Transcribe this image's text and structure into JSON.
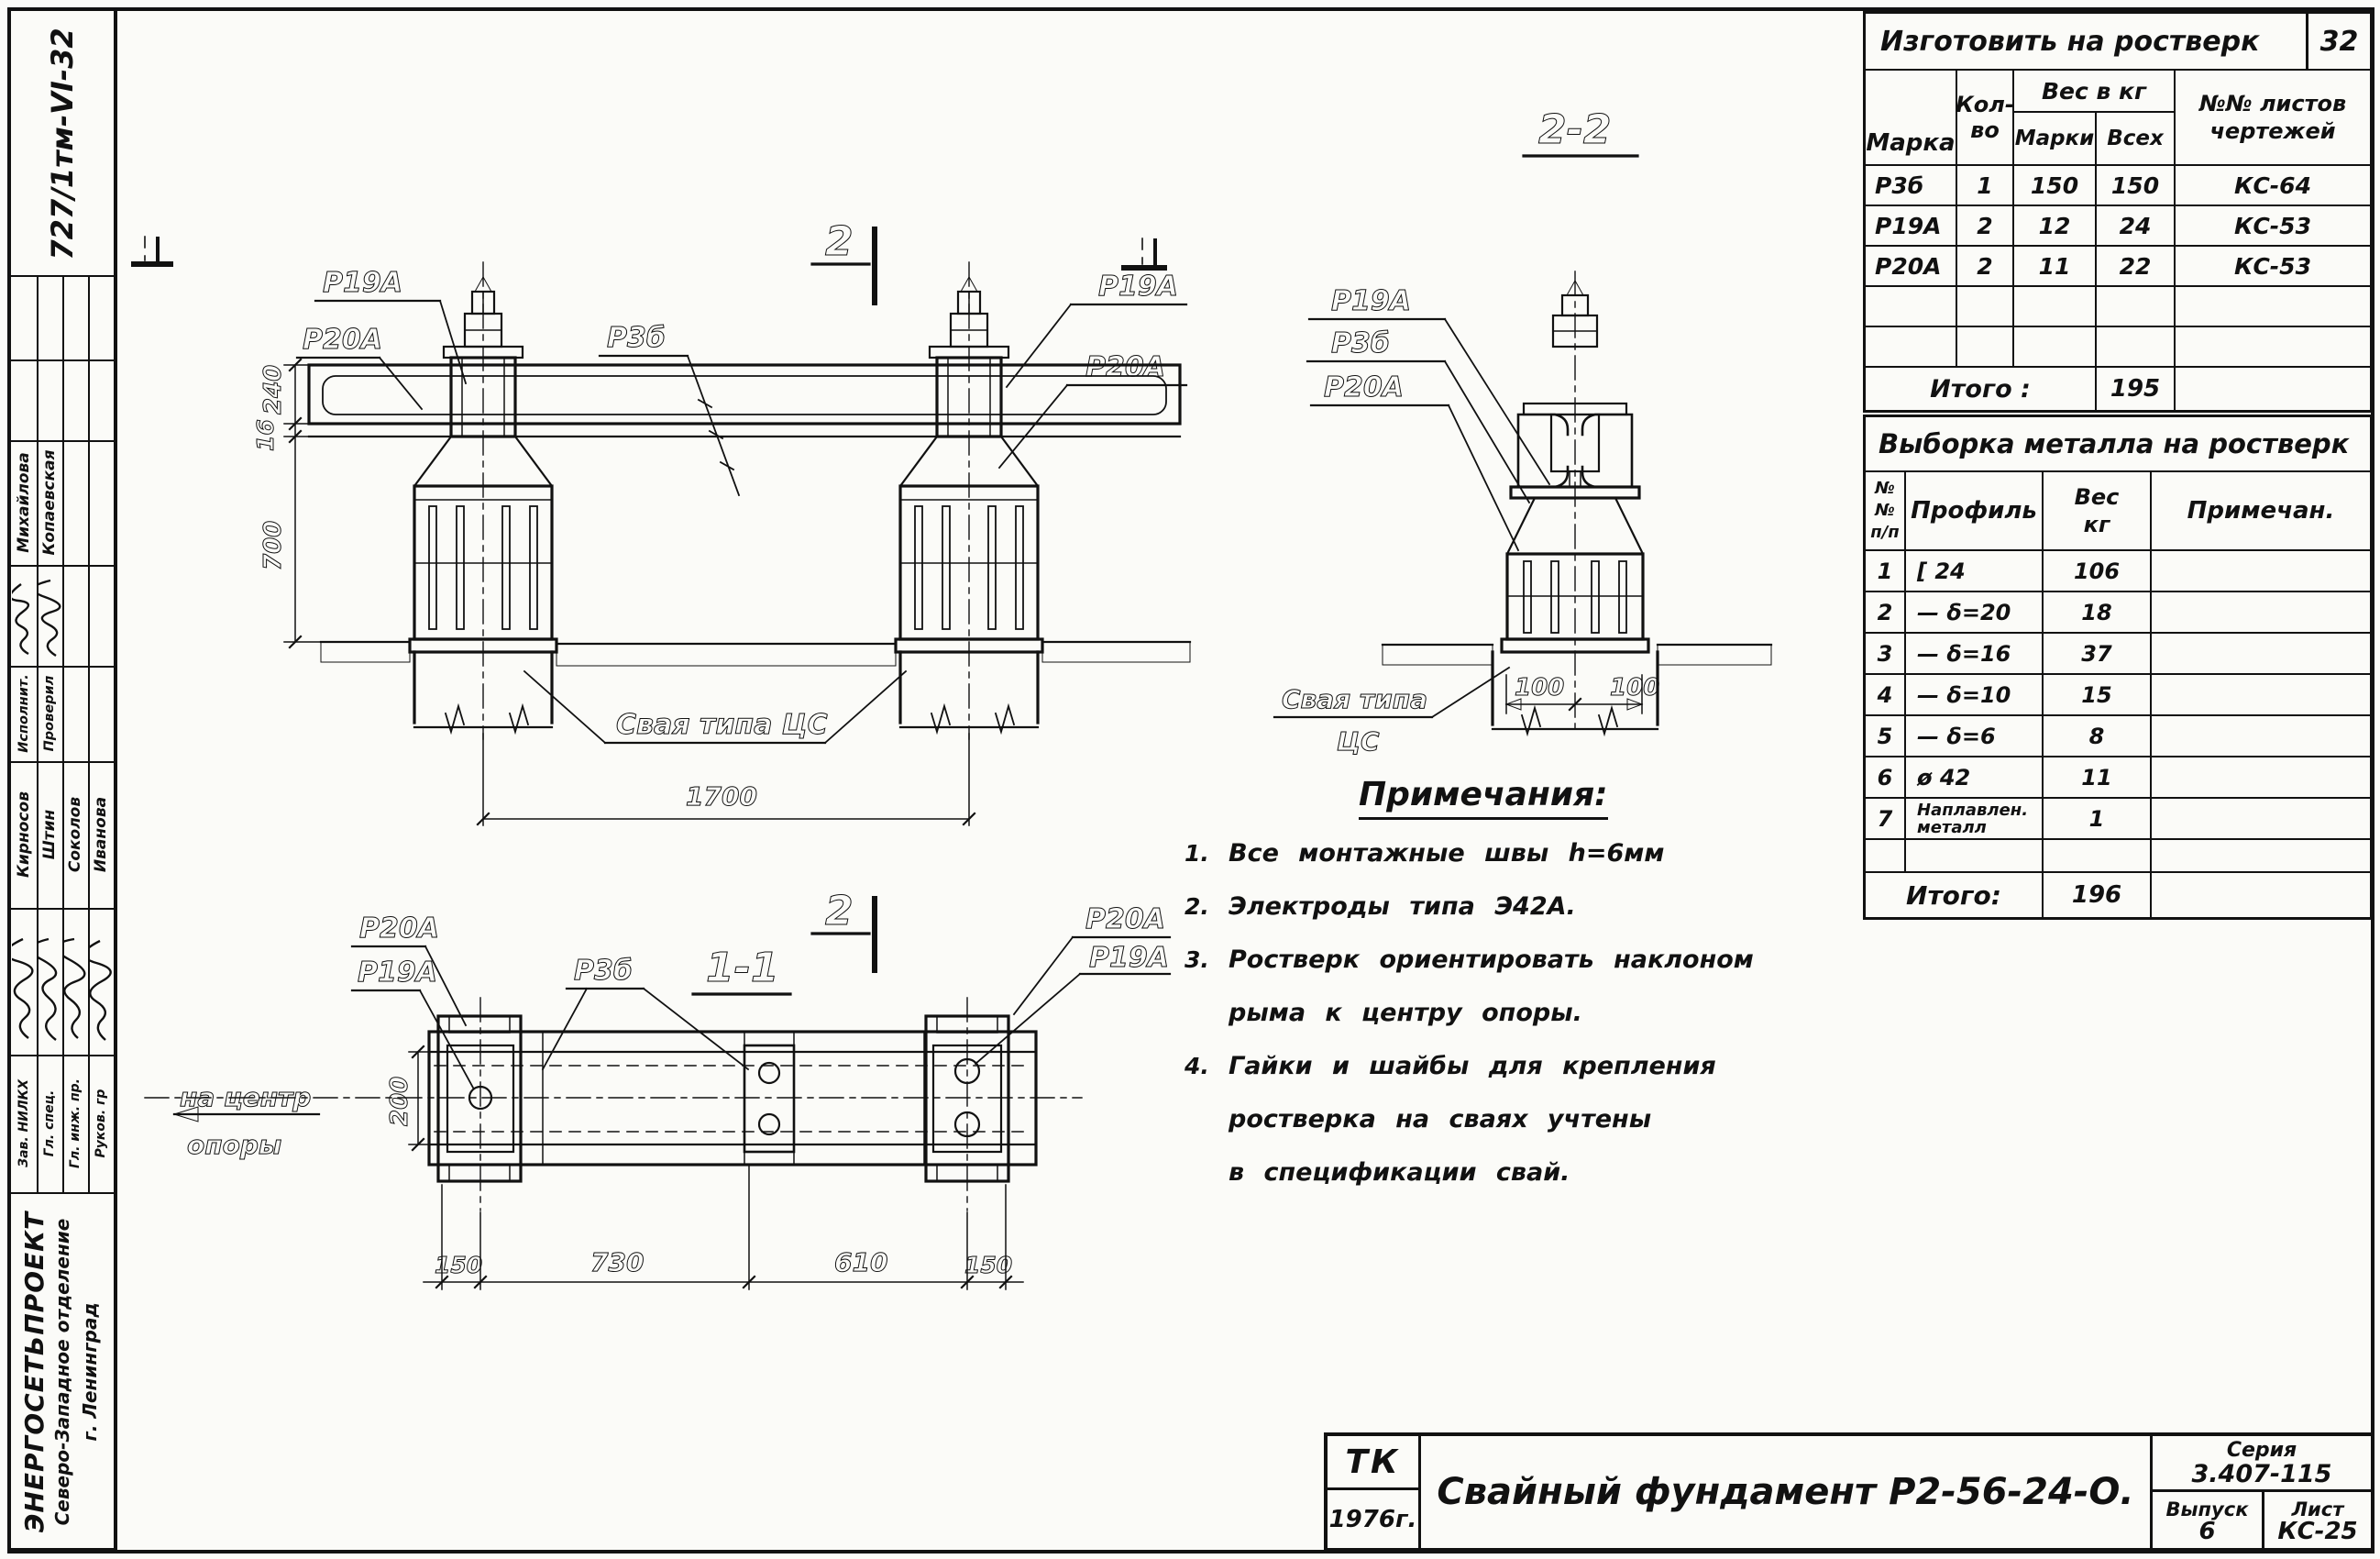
{
  "sheet": {
    "archive_stamp": "727/1тм-VI-32",
    "org": {
      "name": "ЭНЕРГОСЕТЬПРОЕКТ",
      "branch": "Северо-Западное отделение",
      "city": "г. Ленинград"
    }
  },
  "sidebar": {
    "top_signers": [
      {
        "role": "Исполнит.",
        "name": "Михайлова"
      },
      {
        "role": "Проверил",
        "name": "Копаевская"
      }
    ],
    "bottom_signers": [
      {
        "role": "Зав. НИЛКХ",
        "name": "Кирносов"
      },
      {
        "role": "Гл. спец.",
        "name": "Штин"
      },
      {
        "role": "Гл. инж. пр.",
        "name": "Соколов"
      },
      {
        "role": "Руков. гр",
        "name": "Иванова"
      }
    ]
  },
  "fab_table": {
    "title": "Изготовить на ростверк",
    "badge": "32",
    "headers": {
      "marka": "Марка",
      "qty1": "Кол-",
      "qty2": "во",
      "weight_group": "Вес в кг",
      "w_each": "Марки",
      "w_all": "Всех",
      "sheets1": "№№ листов",
      "sheets2": "чертежей"
    },
    "rows": [
      {
        "marka": "Р3б",
        "qty": "1",
        "w_each": "150",
        "w_all": "150",
        "sheets": "КС-64"
      },
      {
        "marka": "Р19А",
        "qty": "2",
        "w_each": "12",
        "w_all": "24",
        "sheets": "КС-53"
      },
      {
        "marka": "Р20А",
        "qty": "2",
        "w_each": "11",
        "w_all": "22",
        "sheets": "КС-53"
      },
      {
        "marka": "",
        "qty": "",
        "w_each": "",
        "w_all": "",
        "sheets": ""
      },
      {
        "marka": "",
        "qty": "",
        "w_each": "",
        "w_all": "",
        "sheets": ""
      }
    ],
    "total_label": "Итого :",
    "total_value": "195"
  },
  "metal_table": {
    "title": "Выборка металла на ростверк",
    "headers": {
      "num1": "№№",
      "num2": "п/п",
      "profile": "Профиль",
      "w1": "Вес",
      "w2": "кг",
      "note": "Примечан."
    },
    "rows": [
      {
        "num": "1",
        "profile": "[ 24",
        "weight": "106"
      },
      {
        "num": "2",
        "profile": "— δ=20",
        "weight": "18"
      },
      {
        "num": "3",
        "profile": "— δ=16",
        "weight": "37"
      },
      {
        "num": "4",
        "profile": "— δ=10",
        "weight": "15"
      },
      {
        "num": "5",
        "profile": "— δ=6",
        "weight": "8"
      },
      {
        "num": "6",
        "profile": "ø 42",
        "weight": "11"
      },
      {
        "num": "7",
        "profile": "Наплавлен. металл",
        "weight": "1"
      },
      {
        "num": "",
        "profile": "",
        "weight": ""
      }
    ],
    "total_label": "Итого:",
    "total_value": "196"
  },
  "notes": {
    "title": "Примечания:",
    "items": [
      {
        "n": "1.",
        "text": "Все монтажные швы h=6мм"
      },
      {
        "n": "2.",
        "text": "Электроды типа Э42А."
      },
      {
        "n": "3.",
        "text": "Ростверк ориентировать наклоном\nрыма к центру опоры."
      },
      {
        "n": "4.",
        "text": "Гайки и шайбы для крепления\nростверка на сваях учтены\nв спецификации свай."
      }
    ]
  },
  "title_block": {
    "stamp": "ТК",
    "year": "1976г.",
    "doc_title": "Свайный фундамент Р2-56-24-О.",
    "series_label": "Серия",
    "series": "3.407-115",
    "issue_label": "Выпуск",
    "issue": "6",
    "sheet_label": "Лист",
    "sheet": "КС-25"
  },
  "drawing": {
    "marks": {
      "p19a": "Р19А",
      "p20a": "Р20А",
      "p3b": "Р3б"
    },
    "section2": "2",
    "elev_pile_label": "Свая типа ЦС",
    "view22": {
      "title": "2-2",
      "pile1": "Свая типа",
      "pile2": "ЦС"
    },
    "view11": {
      "title": "1-1",
      "center1": "на центр",
      "center2": "опоры"
    },
    "dims": {
      "d240": "240",
      "d16": "16",
      "d700": "700",
      "d1700": "1700",
      "d100": "100",
      "d200": "200",
      "d150": "150",
      "d730": "730",
      "d610": "610"
    }
  }
}
